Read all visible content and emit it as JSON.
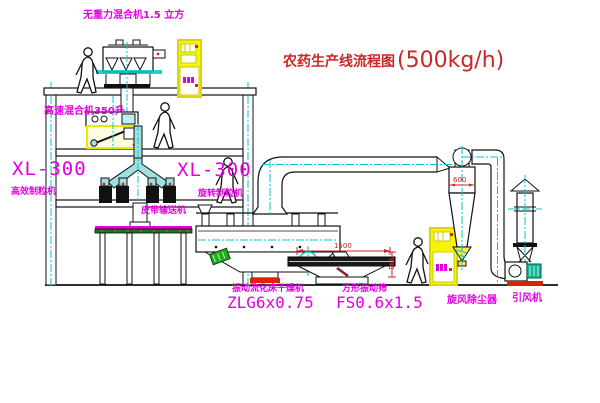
{
  "title": {
    "cn": "农药生产线流程图",
    "capacity": "(500kg/h)"
  },
  "labels": {
    "gravity_mixer": "无重力混合机1.5 立方",
    "high_speed_mixer": "高速混合机350升",
    "xl300_left": "XL-300",
    "granulator_left": "高效制粒机",
    "xl300_right": "XL-300",
    "granulator_right": "旋转制粒机",
    "belt_conveyor": "皮带输送机",
    "dryer_cn": "振动流化床干燥机",
    "dryer_model": "ZLG6x0.75",
    "screen_cn": "方形振动筛",
    "screen_model": "FS0.6x1.5",
    "cyclone": "旋风除尘器",
    "fan": "引风机"
  },
  "dimensions": {
    "cyclone_width": "600",
    "screen_length": "1500",
    "screen_height": "541"
  },
  "colors": {
    "label_magenta": "#e200e2",
    "annotation_red": "#cc2626",
    "centerline_cyan": "#00c8c8",
    "cabinet_yellow": "#f0f000",
    "machine_green": "#22aa22"
  }
}
